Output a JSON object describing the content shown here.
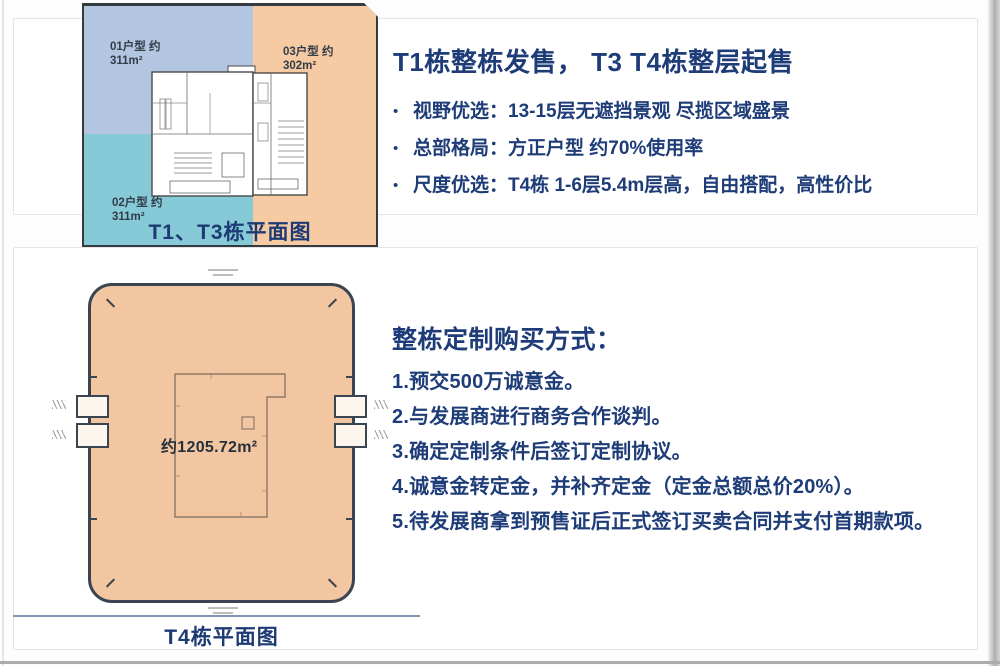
{
  "ui": {
    "bullet_glyph": "•"
  },
  "colors": {
    "accent_navy": "#1e3c78",
    "plan_blue": "#b2c6e2",
    "plan_teal": "#86c9d7",
    "plan_orange": "#f6cba3",
    "plan_peach": "#f3c6a2"
  },
  "top_panel": {
    "floorplan": {
      "caption": "T1、T3栋平面图",
      "unit_01": {
        "name": "01户型 约",
        "area": "311m²"
      },
      "unit_02": {
        "name": "02户型 约",
        "area": "311m²"
      },
      "unit_03": {
        "name": "03户型 约",
        "area": "302m²"
      }
    },
    "title": "T1栋整栋发售， T3 T4栋整层起售",
    "bullets": [
      "视野优选：13-15层无遮挡景观 尽揽区域盛景",
      "总部格局：方正户型 约70%使用率",
      "尺度优选：T4栋 1-6层5.4m层高，自由搭配，高性价比"
    ]
  },
  "bottom_panel": {
    "floorplan": {
      "caption": "T4栋平面图",
      "area_label": "约1205.72m²"
    },
    "heading": "整栋定制购买方式：",
    "steps": [
      "1.预交500万诚意金。",
      "2.与发展商进行商务合作谈判。",
      "3.确定定制条件后签订定制协议。",
      "4.诚意金转定金，并补齐定金（定金总额总价20%）。",
      "5.待发展商拿到预售证后正式签订买卖合同并支付首期款项。"
    ]
  }
}
